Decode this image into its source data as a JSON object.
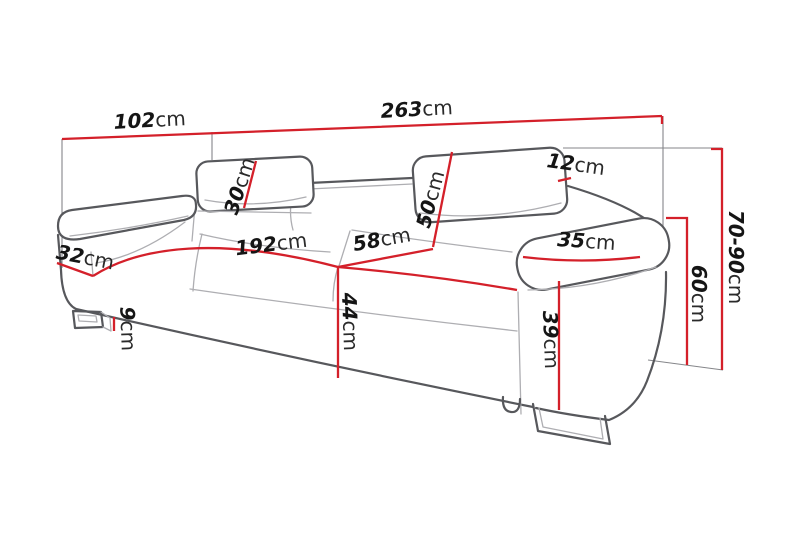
{
  "diagram": {
    "kind": "sofa-dimension-drawing",
    "unit": "cm",
    "colors": {
      "dimension_red": "#d4202a",
      "sketch_dark_gray": "#57585c",
      "sketch_light_gray": "#aeaeb2",
      "reference_gray": "#85868a",
      "label_black": "#151515",
      "background": "#ffffff"
    },
    "dimensions": {
      "d102": {
        "value": "102",
        "unit": "cm"
      },
      "d263": {
        "value": "263",
        "unit": "cm"
      },
      "d30": {
        "value": "30",
        "unit": "cm"
      },
      "d50": {
        "value": "50",
        "unit": "cm"
      },
      "d12": {
        "value": "12",
        "unit": "cm"
      },
      "d192": {
        "value": "192",
        "unit": "cm"
      },
      "d58": {
        "value": "58",
        "unit": "cm"
      },
      "d35": {
        "value": "35",
        "unit": "cm"
      },
      "d32": {
        "value": "32",
        "unit": "cm"
      },
      "d9": {
        "value": "9",
        "unit": "cm"
      },
      "d44": {
        "value": "44",
        "unit": "cm"
      },
      "d39": {
        "value": "39",
        "unit": "cm"
      },
      "d60": {
        "value": "60",
        "unit": "cm"
      },
      "d70_90": {
        "value": "70-90",
        "unit": "cm"
      }
    }
  }
}
